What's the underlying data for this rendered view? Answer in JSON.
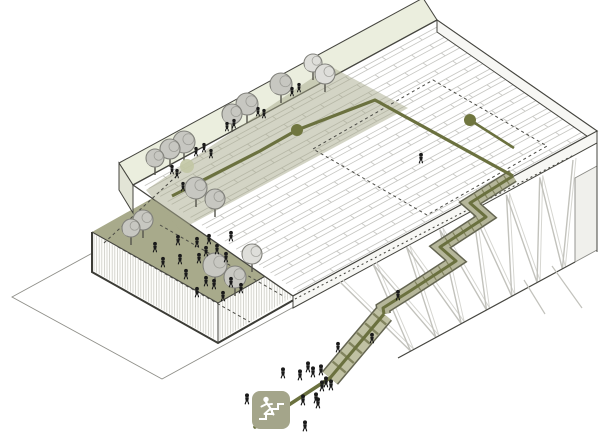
{
  "diagram": {
    "type": "axonometric-architecture-diagram",
    "legend_icon": "person-climbing-stairs",
    "colors": {
      "outline": "#45453f",
      "rowLine": "#c7c7c3",
      "roofFill": "#ffffff",
      "slabFill": "#f7f7f4",
      "stripFill": "#ebeede",
      "stripCap": "#e2e4d6",
      "plaza": "#a8aa8b",
      "band": "#a8aa8b",
      "path": "#6b713f",
      "node": "#70763f",
      "paleNode": "#c2c6a4",
      "stair": "#b5b69a",
      "stairEdge": "#646551",
      "ramp": "#c0c1a3",
      "tread": "#82845f",
      "tree": "#c7c7c1",
      "treePale": "#dededa",
      "treeStroke": "#82827c",
      "trunk": "#55544c",
      "person": "#1a1a1a",
      "hatch": "#cdcdc6",
      "truss": "#c2c2bc",
      "trussLight": "#d6d6d1",
      "neFace": "#f0f0ec",
      "iconBg": "#a4a58a",
      "iconGlyph": "#ffffff",
      "dash": "#4a4a44",
      "ground": "#8f8f89"
    },
    "geometry": {
      "roof": {
        "N": [
          437,
          20
        ],
        "E": [
          597,
          131
        ],
        "S": [
          293,
          296
        ],
        "W": [
          133,
          185
        ],
        "rows": 14
      },
      "slabSE": [
        [
          293,
          296
        ],
        [
          597,
          131
        ],
        [
          597,
          143
        ],
        [
          293,
          308
        ]
      ],
      "slabNE": [
        [
          437,
          20
        ],
        [
          597,
          131
        ],
        [
          597,
          143
        ],
        [
          437,
          32
        ]
      ],
      "strip": [
        [
          119,
          163
        ],
        [
          423,
          -2
        ],
        [
          437,
          20
        ],
        [
          133,
          185
        ]
      ],
      "stripCap": [
        [
          119,
          163
        ],
        [
          133,
          185
        ],
        [
          133,
          213
        ],
        [
          119,
          190
        ]
      ],
      "plaza": [
        [
          92,
          232
        ],
        [
          240,
          149
        ],
        [
          366,
          220
        ],
        [
          218,
          303
        ]
      ],
      "wallSW": [
        [
          92,
          232
        ],
        [
          218,
          303
        ],
        [
          218,
          343
        ],
        [
          92,
          272
        ]
      ],
      "wallSE": [
        [
          218,
          303
        ],
        [
          320,
          245
        ],
        [
          320,
          285
        ],
        [
          218,
          343
        ]
      ],
      "diamond": [
        [
          12,
          297
        ],
        [
          162,
          215
        ],
        [
          312,
          297
        ],
        [
          162,
          379
        ]
      ],
      "band": [
        [
          146,
          190
        ],
        [
          330,
          66
        ],
        [
          408,
          108
        ],
        [
          180,
          230
        ]
      ],
      "dashedRect": [
        [
          433,
          80
        ],
        [
          547,
          146
        ],
        [
          427,
          215
        ],
        [
          313,
          149
        ]
      ],
      "dottedEdges": [
        [
          295,
          299,
          574,
          155
        ]
      ],
      "plazaDashes": [
        [
          104,
          243,
          183,
          170
        ],
        [
          118,
          247,
          250,
          322
        ],
        [
          160,
          225,
          285,
          297
        ]
      ],
      "trussTop": [
        [
          340,
          282
        ],
        [
          573,
          160
        ]
      ],
      "trussBottom": [
        [
          398,
          358
        ],
        [
          575,
          262
        ]
      ],
      "neFace": [
        [
          575,
          262
        ],
        [
          575,
          178
        ],
        [
          597,
          166
        ],
        [
          597,
          250
        ]
      ],
      "bottomEdge": [
        398,
        358,
        575,
        262
      ],
      "rightVertical": [
        597,
        143,
        597,
        252
      ],
      "strays": [
        [
          552,
          266,
          582,
          308
        ],
        [
          524,
          280,
          545,
          314
        ]
      ]
    },
    "route": {
      "roof": [
        [
          172,
          196
        ],
        [
          260,
          151
        ],
        [
          297,
          130
        ],
        [
          375,
          100
        ],
        [
          513,
          176
        ]
      ],
      "stair": [
        [
          513,
          176
        ],
        [
          470,
          203
        ],
        [
          486,
          217
        ],
        [
          440,
          247
        ],
        [
          456,
          261
        ],
        [
          410,
          291
        ],
        [
          383,
          308
        ],
        [
          384,
          314
        ]
      ],
      "ramp": [
        [
          384,
          314
        ],
        [
          330,
          378
        ]
      ],
      "ground": [
        [
          330,
          378
        ],
        [
          255,
          427
        ]
      ]
    },
    "nodes": {
      "n1": {
        "c": [
          297,
          130
        ],
        "r": 6
      },
      "n2": {
        "c": [
          470,
          120
        ],
        "r": 6
      },
      "stem": [
        470,
        120,
        514,
        148
      ],
      "pale": {
        "c": [
          187,
          166
        ],
        "r": 7
      }
    },
    "trees": [
      {
        "x": 313,
        "y": 63,
        "r": 9,
        "pale": true
      },
      {
        "x": 325,
        "y": 74,
        "r": 10,
        "pale": true
      },
      {
        "x": 281,
        "y": 84,
        "r": 11,
        "pale": false
      },
      {
        "x": 247,
        "y": 104,
        "r": 11,
        "pale": false
      },
      {
        "x": 232,
        "y": 114,
        "r": 10,
        "pale": false
      },
      {
        "x": 184,
        "y": 142,
        "r": 11,
        "pale": false
      },
      {
        "x": 170,
        "y": 149,
        "r": 10,
        "pale": false
      },
      {
        "x": 155,
        "y": 158,
        "r": 9,
        "pale": false
      },
      {
        "x": 196,
        "y": 188,
        "r": 11,
        "pale": false
      },
      {
        "x": 215,
        "y": 199,
        "r": 10,
        "pale": false
      },
      {
        "x": 143,
        "y": 220,
        "r": 10,
        "pale": false
      },
      {
        "x": 131,
        "y": 228,
        "r": 9,
        "pale": false
      },
      {
        "x": 215,
        "y": 265,
        "r": 12,
        "pale": false
      },
      {
        "x": 235,
        "y": 277,
        "r": 11,
        "pale": false
      },
      {
        "x": 252,
        "y": 254,
        "r": 10,
        "pale": true
      }
    ],
    "people": {
      "strip": [
        [
          196,
          156
        ],
        [
          204,
          152
        ],
        [
          211,
          158
        ],
        [
          227,
          131
        ],
        [
          234,
          128
        ],
        [
          258,
          116
        ],
        [
          264,
          118
        ],
        [
          172,
          174
        ],
        [
          177,
          178
        ],
        [
          183,
          191
        ],
        [
          292,
          96
        ],
        [
          299,
          92
        ]
      ],
      "plaza": [
        [
          178,
          245
        ],
        [
          197,
          247
        ],
        [
          209,
          244
        ],
        [
          231,
          241
        ],
        [
          206,
          256
        ],
        [
          217,
          254
        ],
        [
          226,
          262
        ],
        [
          199,
          263
        ],
        [
          180,
          264
        ],
        [
          163,
          267
        ],
        [
          186,
          279
        ],
        [
          206,
          286
        ],
        [
          214,
          289
        ],
        [
          231,
          287
        ],
        [
          197,
          297
        ],
        [
          223,
          301
        ],
        [
          241,
          293
        ],
        [
          155,
          252
        ]
      ],
      "ground": [
        [
          283,
          378
        ],
        [
          300,
          380
        ],
        [
          308,
          372
        ],
        [
          313,
          377
        ],
        [
          321,
          375
        ],
        [
          326,
          387
        ],
        [
          331,
          390
        ],
        [
          303,
          405
        ],
        [
          316,
          403
        ],
        [
          318,
          408
        ],
        [
          287,
          423
        ],
        [
          305,
          431
        ],
        [
          247,
          404
        ],
        [
          322,
          391
        ]
      ],
      "stairs": [
        [
          338,
          352
        ],
        [
          372,
          343
        ],
        [
          398,
          300
        ],
        [
          421,
          163
        ]
      ]
    },
    "icon": {
      "x": 252,
      "y": 391,
      "size": 38
    }
  }
}
